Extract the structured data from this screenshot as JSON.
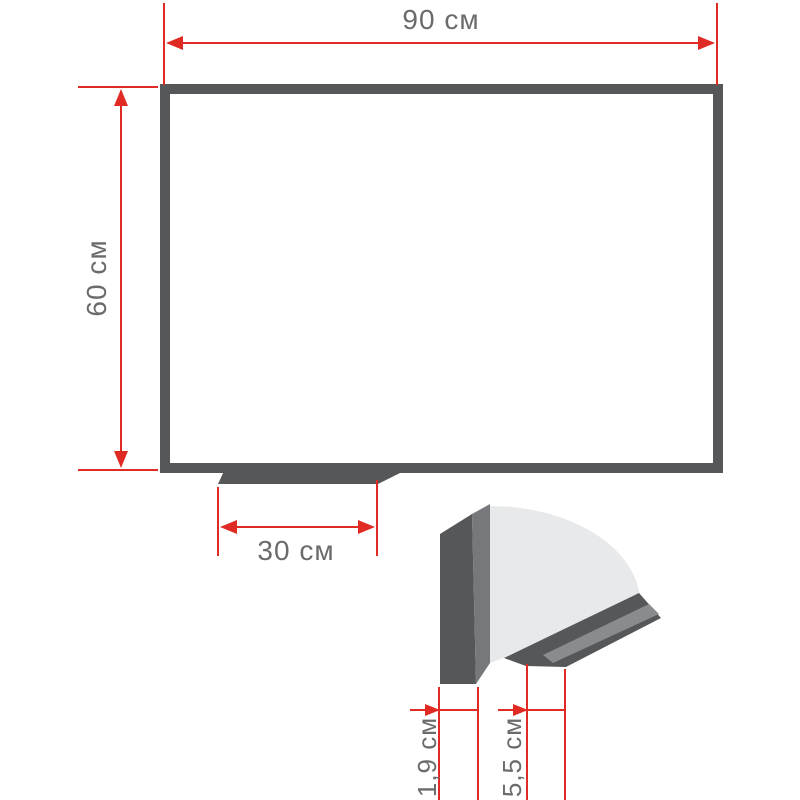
{
  "diagram": {
    "type": "dimension-drawing",
    "subject": "whiteboard with pen tray and corner cross-section detail",
    "labels": {
      "board_width": "90 см",
      "board_height": "60 см",
      "tray_width": "30 см",
      "frame_depth": "1,9 см",
      "tray_depth": "5,5 см"
    },
    "colors": {
      "dimension_red": "#e02a24",
      "frame_gray": "#565759",
      "frame_edge_gray": "#77787b",
      "board_sheet_light": "#e8e9ea",
      "tray_stripe_gray": "#8a8b8e",
      "label_text": "#6a6b6d",
      "background": "#ffffff"
    }
  }
}
